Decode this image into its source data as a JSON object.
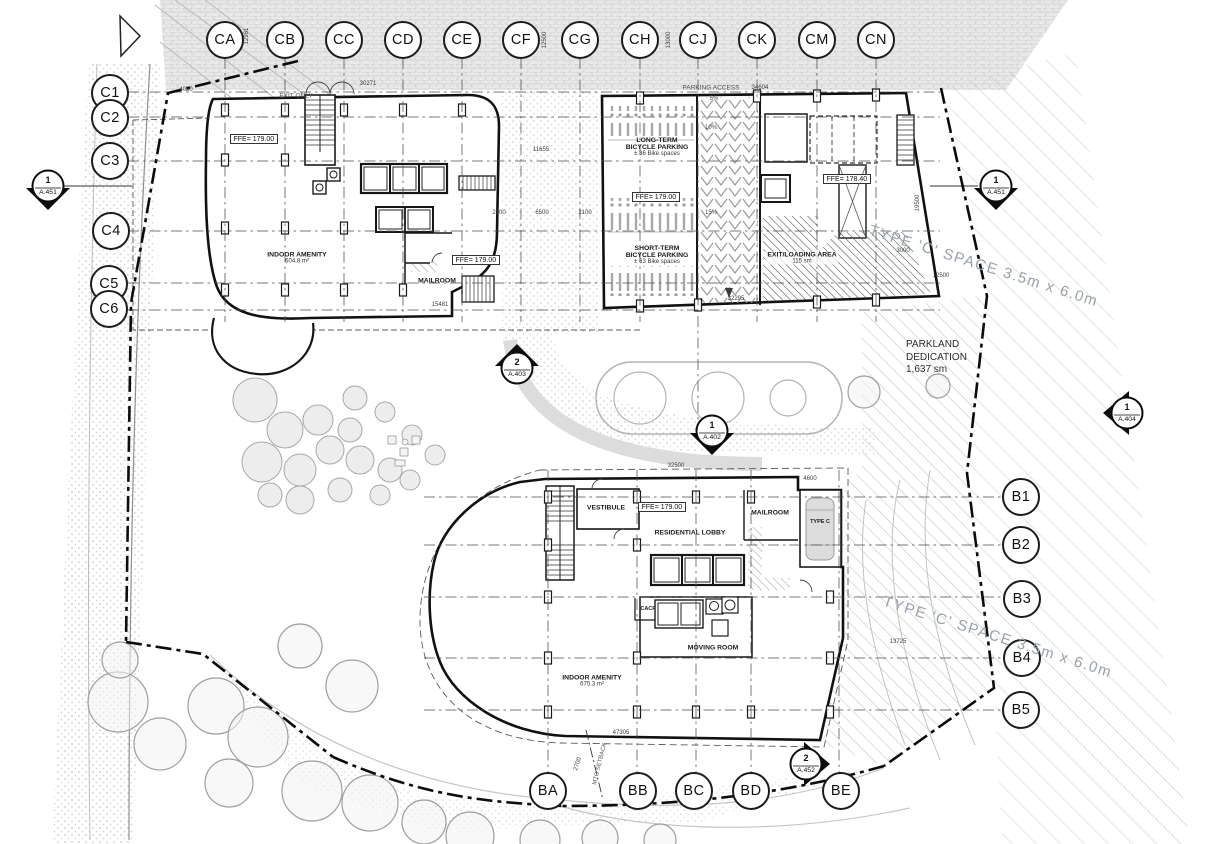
{
  "drawing": {
    "kind": "architectural site plan",
    "sheet_background": "#ffffff",
    "line_color": "#1a1a1a",
    "texture_gray": "#c9c9c9"
  },
  "grid": {
    "top": [
      "CA",
      "CB",
      "CC",
      "CD",
      "CE",
      "CF",
      "CG",
      "CH",
      "CJ",
      "CK",
      "CM",
      "CN"
    ],
    "left": [
      "C1",
      "C2",
      "C3",
      "C4",
      "C5",
      "C6"
    ],
    "right": [
      "B1",
      "B2",
      "B3",
      "B4",
      "B5"
    ],
    "bottom": [
      "BA",
      "BB",
      "BC",
      "BD",
      "BE"
    ]
  },
  "markers": [
    {
      "num": "1",
      "sheet": "A.451"
    },
    {
      "num": "1",
      "sheet": "A.451"
    },
    {
      "num": "2",
      "sheet": "A.403"
    },
    {
      "num": "1",
      "sheet": "A.402"
    },
    {
      "num": "1",
      "sheet": "A.404"
    },
    {
      "num": "2",
      "sheet": "A.452"
    }
  ],
  "ffe": {
    "nw": "FFE= 179.00",
    "nw2": "FFE= 179.00",
    "bike": "FFE= 179.00",
    "core": "FFE= 178.40",
    "south": "FFE= 179.00"
  },
  "rooms": {
    "nw_amenity_name": "INDOOR AMENITY",
    "nw_amenity_area": "604.8 m²",
    "nw_mailroom": "MAILROOM",
    "lt_line1": "LONG-TERM",
    "lt_line2": "BICYCLE PARKING",
    "lt_line3": "± 36 Bike spaces",
    "st_line1": "SHORT-TERM",
    "st_line2": "BICYCLE PARKING",
    "st_line3": "± 63 Bike spaces",
    "vestibule": "VESTIBULE",
    "lobby": "RESIDENTIAL LOBBY",
    "s_mailroom": "MAILROOM",
    "moving": "MOVING ROOM",
    "s_amenity_name": "INDOOR AMENITY",
    "s_amenity_area": "675.3 m²",
    "cacf": "CACF",
    "type_c_stall": "TYPE C",
    "loading_name": "EXIT/LOADING AREA",
    "loading_area": "115 sm"
  },
  "site": {
    "exit_only": "EXIT ONLY",
    "parking_access": "PARKING ACCESS",
    "slope5": "5%",
    "slope10": "10%",
    "slope15": "15%",
    "parkland1": "PARKLAND",
    "parkland2": "DEDICATION",
    "parkland3": "1,637 sm",
    "type_c_space": "TYPE 'C' SPACE 3.5m x 6.0m",
    "mto": "MTO SETBACK"
  },
  "dims": [
    "4050",
    "30271",
    "12981",
    "11655",
    "2100",
    "6500",
    "2100",
    "34604",
    "32295",
    "19500",
    "3000",
    "12500",
    "15481",
    "32500",
    "4600",
    "12500",
    "13000",
    "47305",
    "13725",
    "2700"
  ]
}
